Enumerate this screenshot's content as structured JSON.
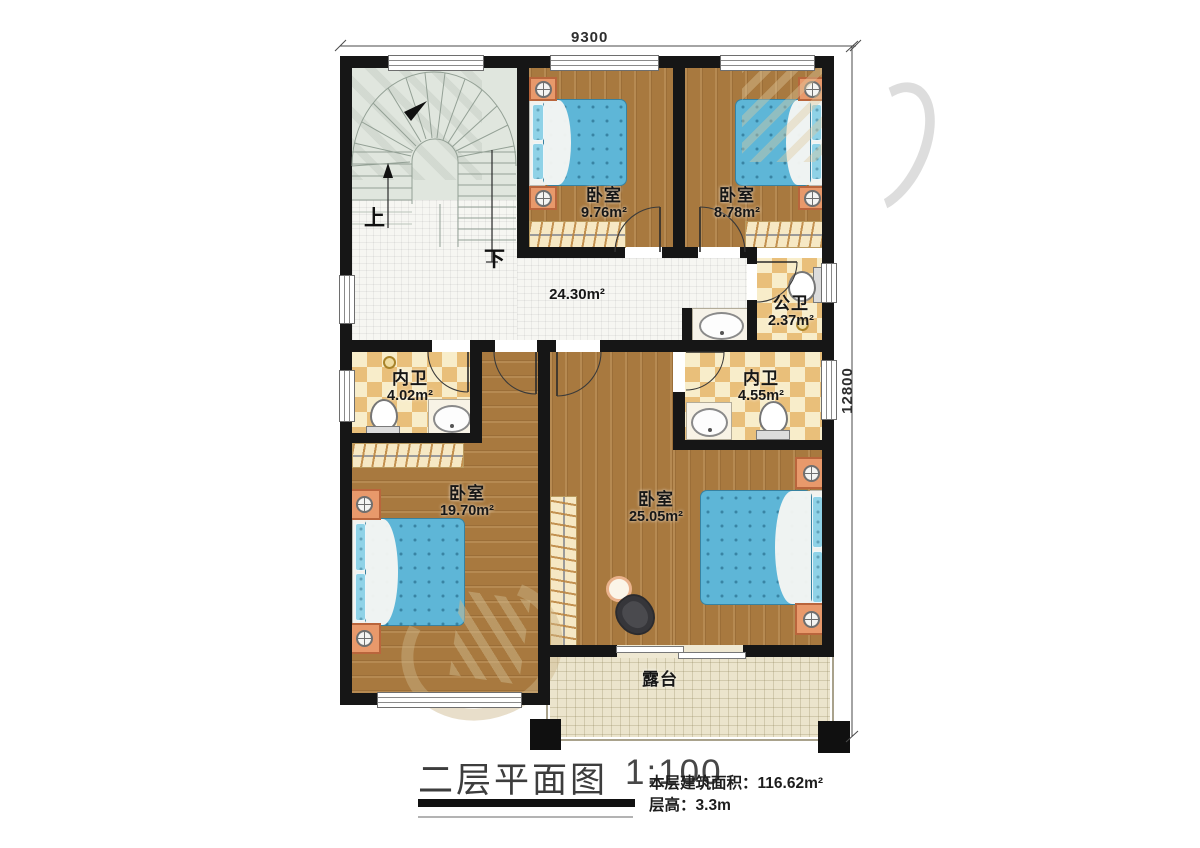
{
  "plan": {
    "dimension_width": "9300",
    "dimension_height": "12800",
    "stairs": {
      "up_label": "上",
      "down_label": "下"
    },
    "rooms": {
      "bedroom_top_left": {
        "name": "卧室",
        "area": "9.76m²"
      },
      "bedroom_top_right": {
        "name": "卧室",
        "area": "8.78m²"
      },
      "corridor": {
        "area": "24.30m²"
      },
      "public_bath": {
        "name": "公卫",
        "area": "2.37m²"
      },
      "ensuite_left": {
        "name": "内卫",
        "area": "4.02m²"
      },
      "ensuite_right": {
        "name": "内卫",
        "area": "4.55m²"
      },
      "bedroom_bottom_left": {
        "name": "卧室",
        "area": "19.70m²"
      },
      "bedroom_bottom_right": {
        "name": "卧室",
        "area": "25.05m²"
      },
      "terrace": {
        "name": "露台"
      }
    }
  },
  "title_block": {
    "title": "二层平面图",
    "scale": "1:100",
    "floor_area_label": "本层建筑面积：",
    "floor_area_value": "116.62m²",
    "floor_height_label": "层高：",
    "floor_height_value": "3.3m"
  },
  "colors": {
    "wall": "#161616",
    "wood_floor": "#a8793f",
    "bath_tile": "#e9bf7a",
    "stair_floor": "#e0e6de",
    "corridor_tile": "#f6f6f2",
    "terrace_floor": "#ebe4cc",
    "bed": "#5eb6d7",
    "nightstand": "#e8996b",
    "wardrobe": "#f6e8c4"
  }
}
